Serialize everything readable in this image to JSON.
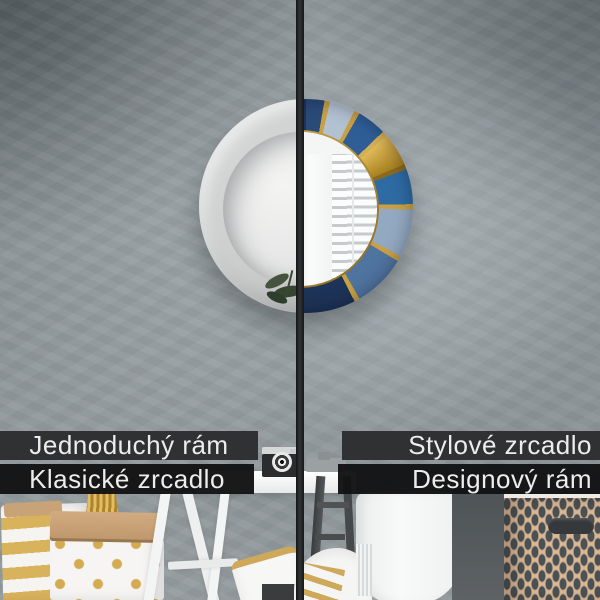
{
  "comparison": {
    "left": {
      "label_top": "Jednoduchý rám",
      "label_bottom": "Klasické zrcadlo"
    },
    "right": {
      "label_top": "Stylové zrcadlo",
      "label_bottom": "Designový rám"
    }
  },
  "colors": {
    "bar_top": "#2c2d2f",
    "bar_bottom": "#131314",
    "label_text": "#ededed",
    "accent_gold": "#c9a144",
    "frame_simple_gray": "#c9cbcb",
    "frame_marble_navy": "#1d3357",
    "frame_marble_blue": "#2f5e97",
    "frame_marble_light": "#b3c2d3",
    "wall_gray": "#8b9396",
    "divider_dark": "#1a1b1d"
  }
}
